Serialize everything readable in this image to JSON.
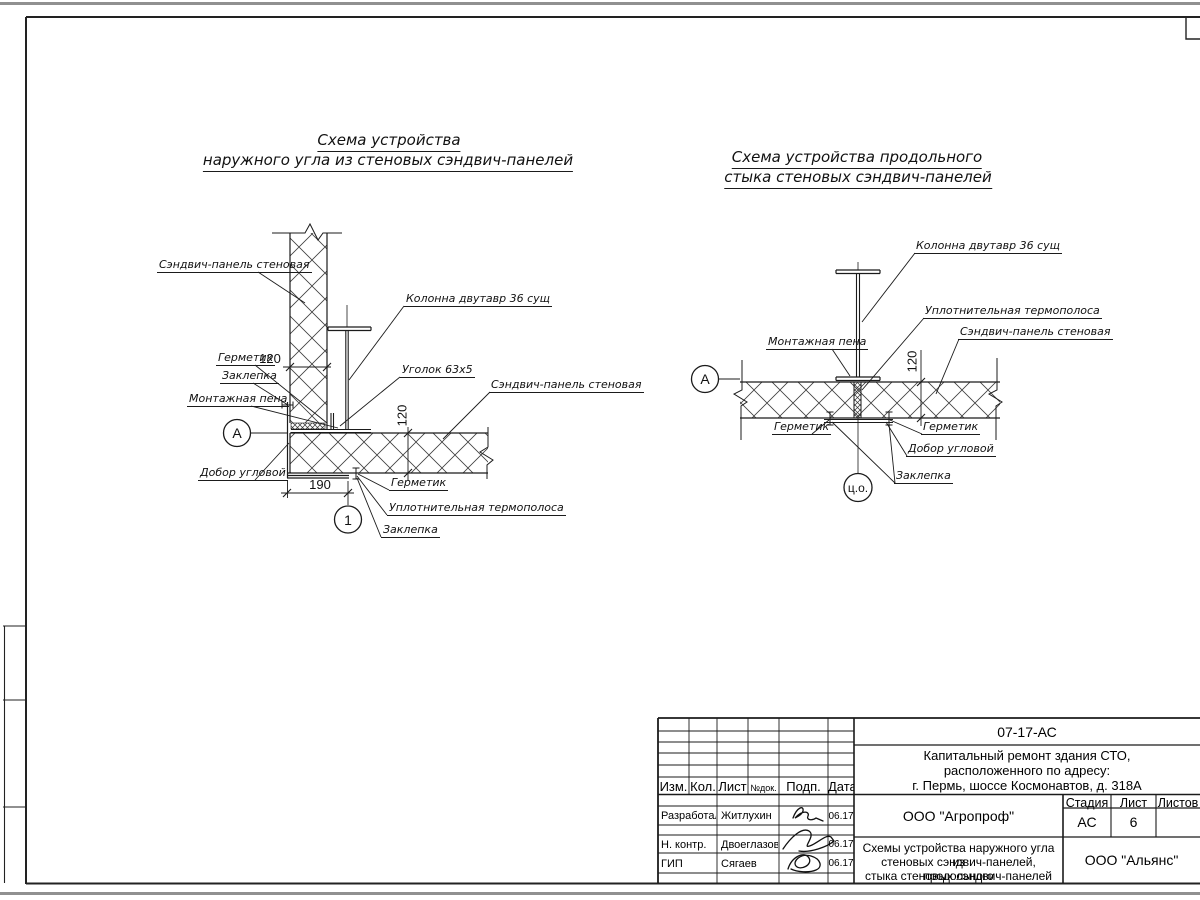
{
  "left_diagram": {
    "title_line1": "Схема устройства",
    "title_line2": "наружного угла из стеновых сэндвич-панелей",
    "labels": {
      "panel": "Сэндвич-панель стеновая",
      "column": "Колонна двутавр 36 сущ",
      "sealant_top": "Герметик",
      "rivet_top": "Заклепка",
      "foam": "Монтажная пена",
      "corner_trim": "Добор угловой",
      "sealant_bottom": "Герметик",
      "thermal_strip": "Уплотнительная термополоса",
      "rivet_bottom": "Заклепка",
      "angle": "Уголок 63х5",
      "panel_right": "Сэндвич-панель стеновая"
    },
    "dimensions": {
      "panel_width": "120",
      "panel_thickness": "120",
      "corner_width": "190"
    },
    "markers": {
      "axis": "А",
      "detail": "1"
    }
  },
  "right_diagram": {
    "title_line1": "Схема устройства продольного",
    "title_line2": "стыка стеновых сэндвич-панелей",
    "labels": {
      "column": "Колонна двутавр 36 сущ",
      "thermal_strip": "Уплотнительная термополоса",
      "panel": "Сэндвич-панель стеновая",
      "foam": "Монтажная пена",
      "sealant_left": "Герметик",
      "sealant_right": "Герметик",
      "corner_trim": "Добор угловой",
      "rivet": "Заклепка"
    },
    "dimensions": {
      "panel_thickness": "120"
    },
    "markers": {
      "axis": "А",
      "center": "ц.о."
    }
  },
  "title_block": {
    "doc_number": "07-17-АС",
    "project_line1": "Капитальный ремонт здания СТО,",
    "project_line2": "расположенного по адресу:",
    "project_line3": "г. Пермь, шоссе Космонавтов, д. 318А",
    "col_izm": "Изм.",
    "col_kol": "Кол.",
    "col_list": "Лист",
    "col_ndok": "№док.",
    "col_podp": "Подп.",
    "col_data": "Дата",
    "staff": [
      {
        "role": "Разработал",
        "name": "Житлухин",
        "date": "06.17"
      },
      {
        "role": "Н. контр.",
        "name": "Двоеглазов",
        "date": "06.17"
      },
      {
        "role": "ГИП",
        "name": "Сягаев",
        "date": "06.17"
      }
    ],
    "stage_label": "Стадия",
    "sheet_label": "Лист",
    "sheets_label": "Листов",
    "stage_value": "АС",
    "sheet_value": "6",
    "designer_org": "ООО \"Агропроф\"",
    "sheet_title_line1": "Схемы устройства наружного угла из",
    "sheet_title_line2": "стеновых сэндвич-панелей, продольного",
    "sheet_title_line3": "стыка стеновых сэндвич-панелей",
    "contractor_org": "ООО \"Альянс\""
  }
}
